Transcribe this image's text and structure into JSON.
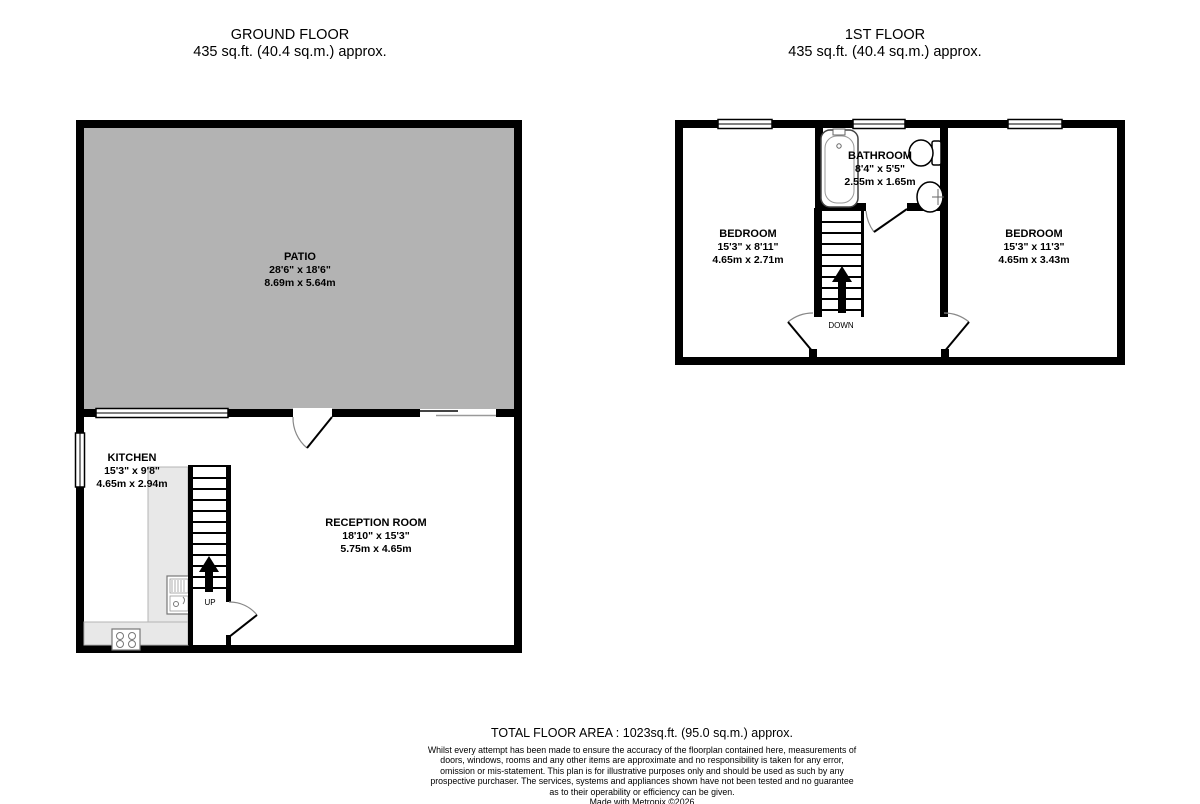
{
  "ground_floor": {
    "title": "GROUND FLOOR",
    "area": "435 sq.ft. (40.4 sq.m.) approx.",
    "rooms": {
      "patio": {
        "name": "PATIO",
        "imperial": "28'6\"  x 18'6\"",
        "metric": "8.69m  x 5.64m"
      },
      "kitchen": {
        "name": "KITCHEN",
        "imperial": "15'3\"  x 9'8\"",
        "metric": "4.65m  x 2.94m"
      },
      "reception": {
        "name": "RECEPTION ROOM",
        "imperial": "18'10\"  x 15'3\"",
        "metric": "5.75m  x 4.65m"
      }
    },
    "stair_label": "UP"
  },
  "first_floor": {
    "title": "1ST FLOOR",
    "area": "435 sq.ft. (40.4 sq.m.) approx.",
    "rooms": {
      "bathroom": {
        "name": "BATHROOM",
        "imperial": "8'4\"  x 5'5\"",
        "metric": "2.55m  x 1.65m"
      },
      "bedroom_left": {
        "name": "BEDROOM",
        "imperial": "15'3\"  x 8'11\"",
        "metric": "4.65m  x 2.71m"
      },
      "bedroom_right": {
        "name": "BEDROOM",
        "imperial": "15'3\"  x 11'3\"",
        "metric": "4.65m  x 3.43m"
      }
    },
    "stair_label": "DOWN"
  },
  "footer": {
    "total_area": "TOTAL FLOOR AREA : 1023sq.ft. (95.0 sq.m.) approx.",
    "disclaimer": "Whilst every attempt has been made to ensure the accuracy of the floorplan contained here, measurements of doors, windows, rooms and any other items are approximate and no responsibility is taken for any error, omission or mis-statement. This plan is for illustrative purposes only and should be used as such by any prospective purchaser. The services, systems and appliances shown have not been tested and no guarantee as to their operability or efficiency can be given.",
    "credit": "Made with Metropix ©2026"
  },
  "colors": {
    "patio_fill": "#b3b3b3",
    "counter_fill": "#e8e8e8",
    "wall": "#000000"
  }
}
